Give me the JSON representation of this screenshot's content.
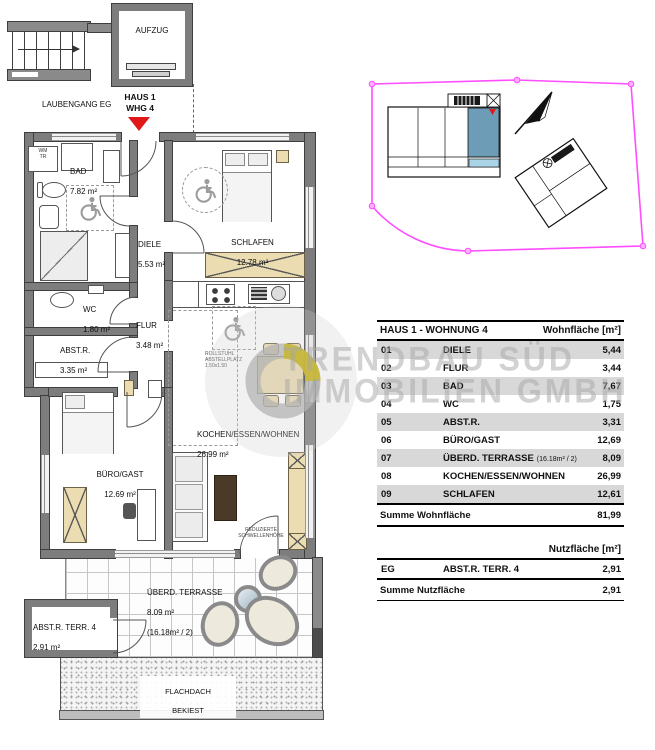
{
  "colors": {
    "wall_gray": "#7d7d7d",
    "furniture_tan": "#ecdcb2",
    "unit_highlight_blue": "#6d9cb7",
    "unit_light_blue": "#a9d4e8",
    "boundary_magenta": "#ff4dff",
    "marker_red": "#e01818",
    "logo_yellow": "#c9b92f",
    "table_stripe": "#d8d8d8",
    "watermark_gray": "#a5a5a5"
  },
  "header_area": {
    "aufzug": "AUFZUG",
    "laubengang": "LAUBENGANG EG",
    "unit_marker": "HAUS 1\nWHG 4"
  },
  "plan": {
    "rooms": {
      "bad": {
        "name": "BAD",
        "area": "7.82 m²"
      },
      "diele": {
        "name": "DIELE",
        "area": "5.53 m²"
      },
      "schlafen": {
        "name": "SCHLAFEN",
        "area": "12.78 m²"
      },
      "wc": {
        "name": "WC",
        "area": "1.80 m²"
      },
      "flur": {
        "name": "FLUR",
        "area": "3.48 m²"
      },
      "abstr": {
        "name": "ABST.R.",
        "area": "3.35 m²"
      },
      "buero": {
        "name": "BÜRO/GAST",
        "area": "12.69 m²"
      },
      "kochen": {
        "name": "KOCHEN/ESSEN/WOHNEN",
        "area": "26.99 m²"
      },
      "terrasse": {
        "name": "ÜBERD. TERRASSE",
        "area": "8.09 m²",
        "note": "(16.18m² / 2)"
      },
      "abstr_terr": {
        "name": "ABST.R. TERR. 4",
        "area": "2.91 m²"
      },
      "flachdach": {
        "line1": "FLACHDACH",
        "line2": "BEKIEST"
      }
    },
    "annotations": {
      "wm_tr": "WM\nTR",
      "rollstuhl": "ROLLSTUHL\nABSTELLPLATZ\n1.50x1.50",
      "schwelle": "REDUZIERTE\nSCHWELLENHÖHE"
    }
  },
  "watermark": {
    "line1": "TRENDBAU SÜD",
    "line2": "IMMOBILIEN GMBH"
  },
  "area_table": {
    "title": "HAUS 1 - WOHNUNG 4",
    "area_col_header": "Wohnfläche [m²]",
    "rows": [
      {
        "num": "01",
        "name": "DIELE",
        "value": "5,44"
      },
      {
        "num": "02",
        "name": "FLUR",
        "value": "3,44"
      },
      {
        "num": "03",
        "name": "BAD",
        "value": "7,67"
      },
      {
        "num": "04",
        "name": "WC",
        "value": "1,75"
      },
      {
        "num": "05",
        "name": "ABST.R.",
        "value": "3,31"
      },
      {
        "num": "06",
        "name": "BÜRO/GAST",
        "value": "12,69"
      },
      {
        "num": "07",
        "name": "ÜBERD. TERRASSE",
        "note": "(16.18m² / 2)",
        "value": "8,09"
      },
      {
        "num": "08",
        "name": "KOCHEN/ESSEN/WOHNEN",
        "value": "26,99"
      },
      {
        "num": "09",
        "name": "SCHLAFEN",
        "value": "12,61"
      }
    ],
    "sum_wohn_label": "Summe Wohnfläche",
    "sum_wohn_value": "81,99",
    "nutz_col_header": "Nutzfläche [m²]",
    "nutz_rows": [
      {
        "num": "EG",
        "name": "ABST.R. TERR. 4",
        "value": "2,91"
      }
    ],
    "sum_nutz_label": "Summe Nutzfläche",
    "sum_nutz_value": "2,91"
  }
}
